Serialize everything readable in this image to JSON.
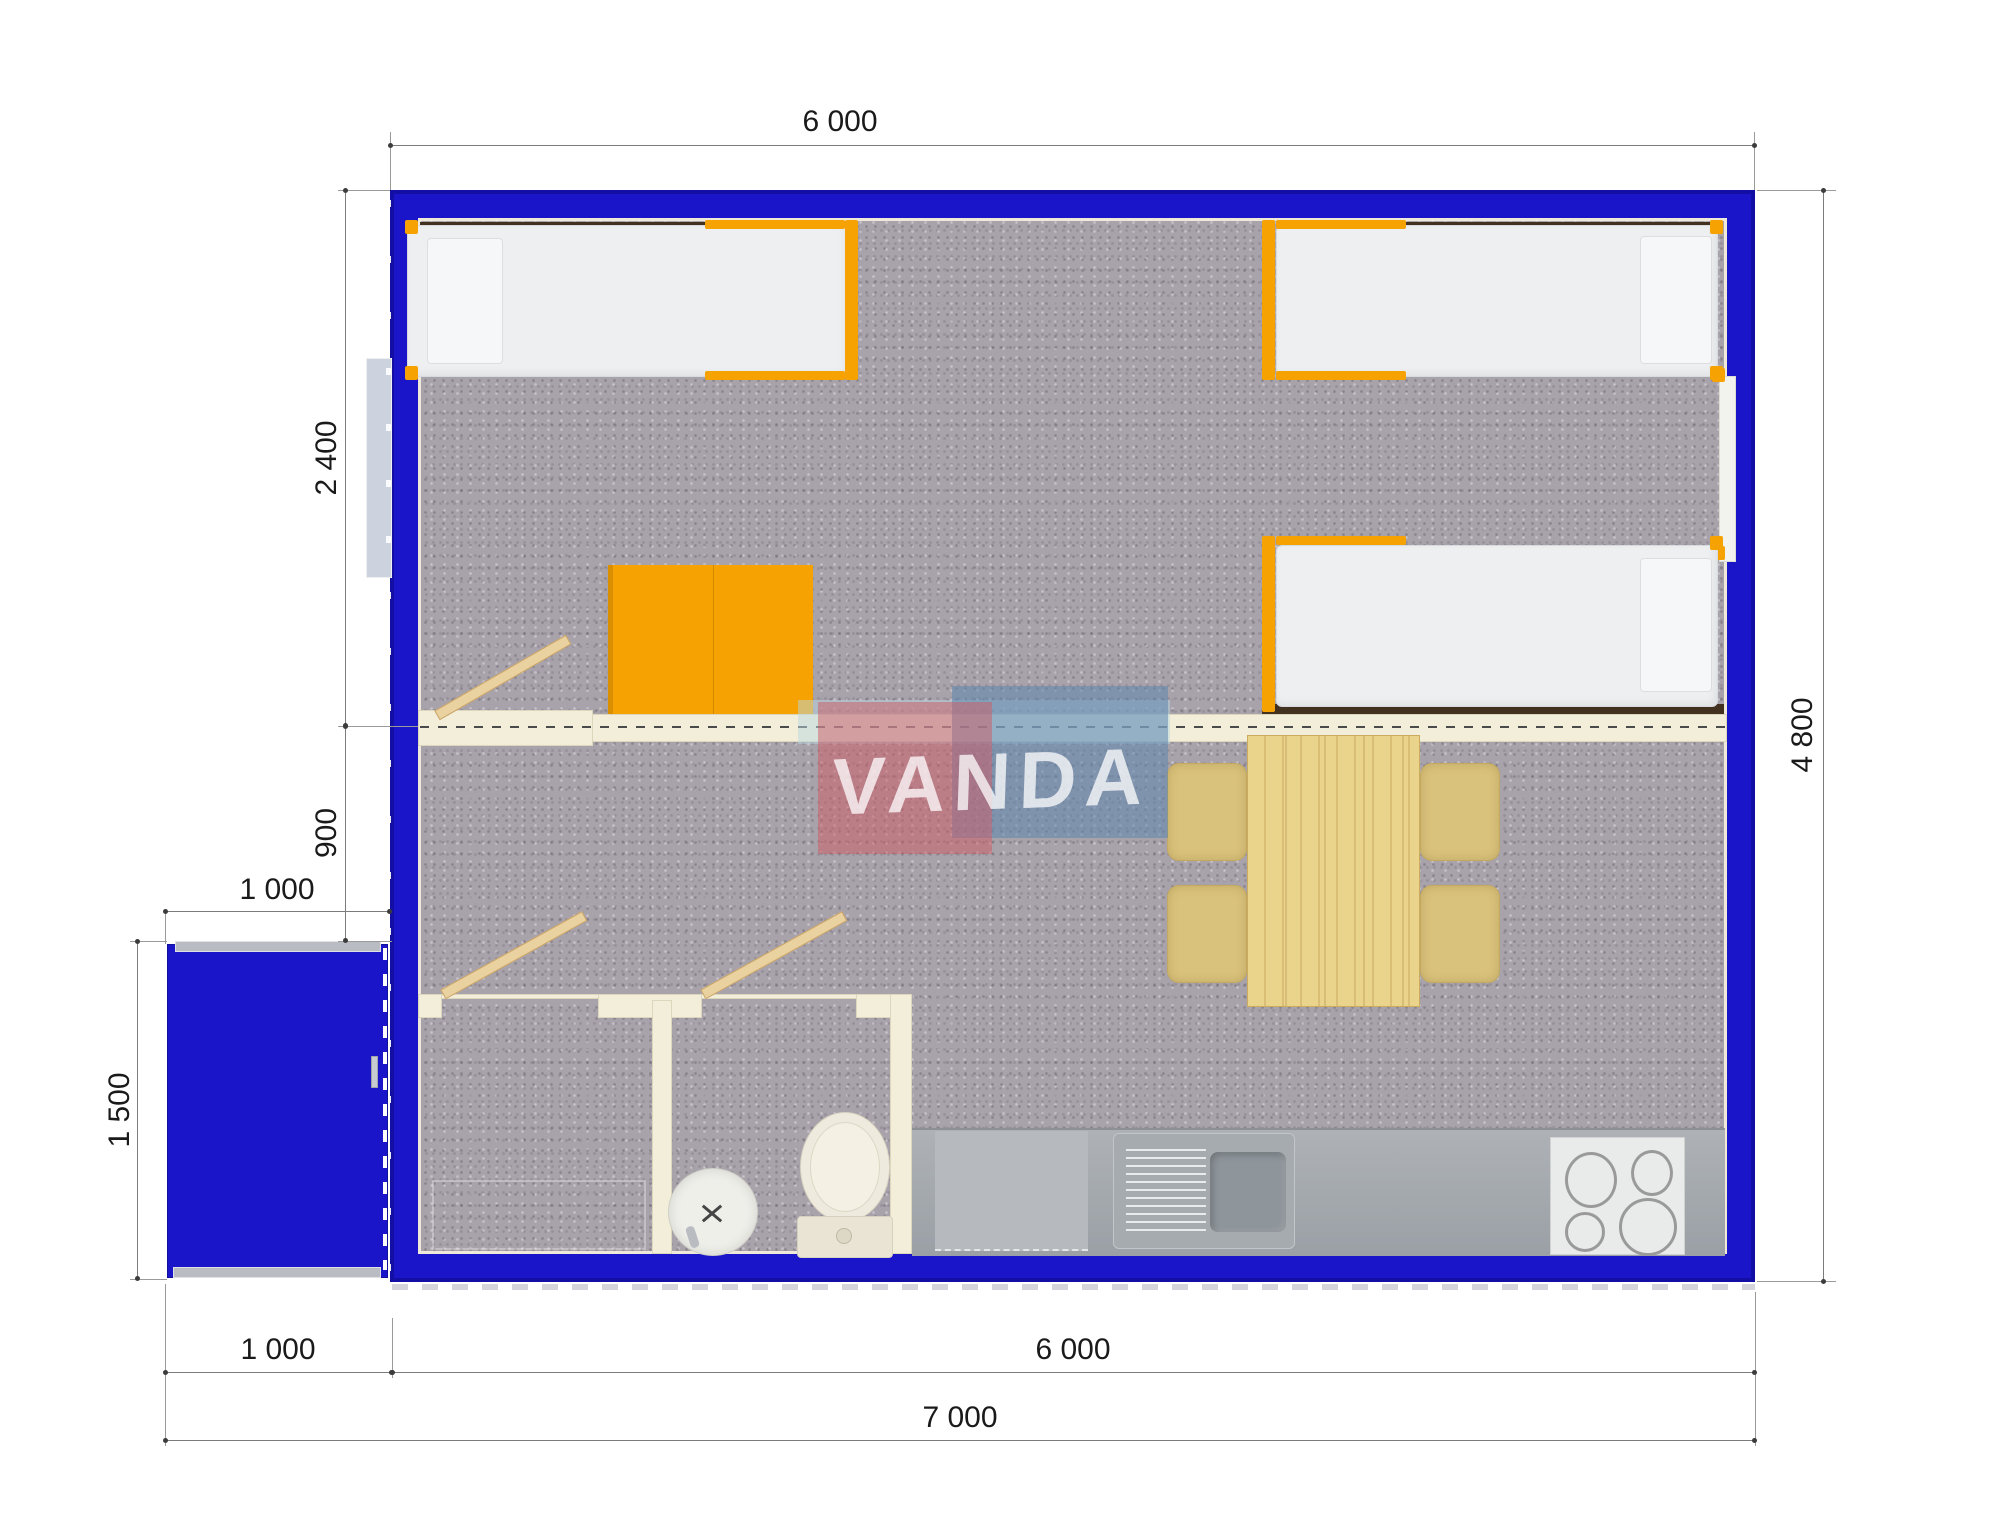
{
  "drawing": {
    "type": "floor-plan-top-view",
    "subject": "modular container house with porch",
    "units": "mm"
  },
  "watermark": {
    "text": "VANDA",
    "red_tile": "#cd5a64",
    "blue_tile": "#5f87af"
  },
  "dimensions": {
    "building_width_top": "6 000",
    "building_depth_right": "4 800",
    "bedroom_depth": "2 400",
    "corridor_depth": "900",
    "porch_width_top": "1 000",
    "porch_depth_left": "1 500",
    "porch_width_bottom": "1 000",
    "building_width_bottom": "6 000",
    "total_width_bottom": "7 000"
  },
  "palette": {
    "wall_blue": "#1a15c9",
    "accent_orange": "#f5a202",
    "partition_cream": "#f2eed9",
    "floor_gray": "#a8a2ab",
    "table_wood": "#ead48c",
    "chair_tan": "#d9c27c",
    "counter_gray": "#a4a8ad"
  },
  "furniture": [
    "single-bed-top-left",
    "single-bed-top-right",
    "single-bed-mid-right",
    "orange-desk",
    "dining-table",
    "dining-chair-x4",
    "kitchen-counter",
    "kitchen-sink",
    "stove-hob-4-burners",
    "toilet",
    "washbasin",
    "shower-room",
    "entrance-porch",
    "entrance-door"
  ]
}
